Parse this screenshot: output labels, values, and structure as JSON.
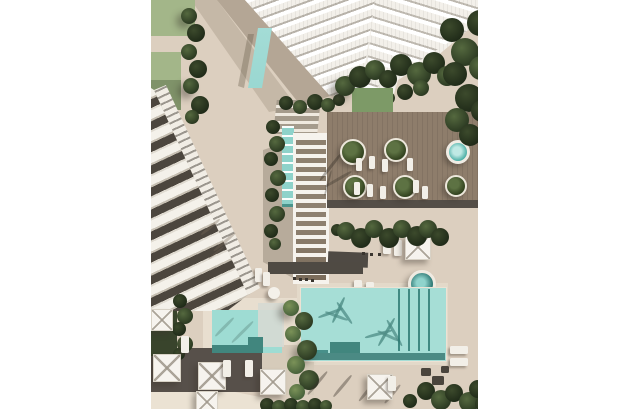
{
  "scene": {
    "type": "aerial-architectural-render",
    "description": "Top-down 3D rendering of a residential resort complex: a white high-rise tower with terraced balconies at top, a diagonal row of townhouses on the left, a white slatted pergola walkway with a narrow lap pool, a wooden sun deck with round tree planters, loungers and a round plunge pool, a large lap pool and a smaller pool below, white square umbrellas on dark decking, lawns, hedges and tree canopies"
  },
  "elements": {
    "tower": "high-rise tower with stepped balconies",
    "townhouses": "row of townhouse roofs and terraces",
    "pergola": "white slatted pergola walkway",
    "lap_pool": "narrow lap pool beside pergola",
    "wooden_deck": "timber sun deck with planters and loungers",
    "plunge_pool_deck": "round plunge pool on deck",
    "plunge_pool_lower": "round plunge pool near main pool",
    "main_pool": "large rectangular swimming pool with lane shadows",
    "small_pool": "smaller rectangular pool",
    "umbrellas": "white square shade umbrellas",
    "loungers": "white sun loungers",
    "entrance_awning": "teal entrance canopy",
    "landscaping": "lawns, hedges, palm and tree canopies"
  },
  "colors": {
    "page": "#ffffff",
    "pavement": "#dccfbf",
    "pavement_light": "#ebe2d3",
    "coping": "#e3d9c9",
    "surround": "#e8decf",
    "patch": "#d6cbba",
    "grass_light": "#a3b689",
    "grass_mid": "#7d9a67",
    "wood_deck": "#8e7d6b",
    "deck_dark": "#57504a",
    "walkway_dark": "#4f4a43",
    "pool_main": "#a6ded6",
    "pool_small": "#9edcd3",
    "pool_lap": "#8ed2ca",
    "pool_step": "#48908a",
    "pool_step_dark": "#41867e",
    "pool_edge": "#4b8a84",
    "awning": "#6ac2ba",
    "jacuzzi": "#3da79e",
    "foliage_dark": "#2c3a22",
    "foliage_mid": "#55693f",
    "building_white": "#f3f0ea",
    "terrace_dark": "#4c463e",
    "umbrella": "#f6f3ee"
  }
}
